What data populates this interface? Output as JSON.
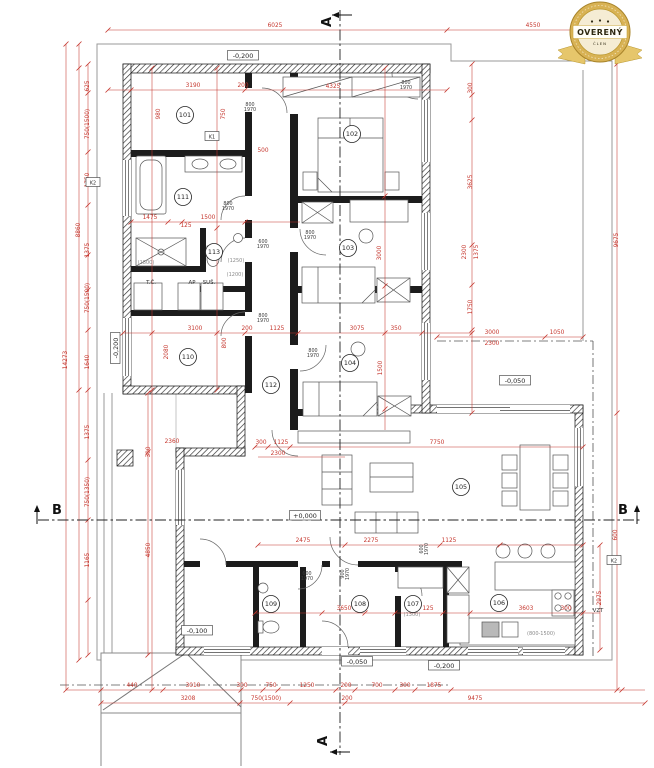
{
  "badge": {
    "title": "OVERENÝ",
    "subtitle": "ČLEN"
  },
  "section": {
    "a": "A",
    "b": "B"
  },
  "colors": {
    "dimension_red": "#c5352c",
    "wall_black": "#1a1a1a",
    "boundary_gray": "#9a9a9a",
    "badge_gold": "#d8b254",
    "badge_cream": "#f5ecd4"
  },
  "levels": [
    {
      "t": "-0,200",
      "x": 243,
      "y": 57,
      "r": 0
    },
    {
      "t": "-0,200",
      "x": 117,
      "y": 348,
      "r": 1
    },
    {
      "t": "+0,000",
      "x": 305,
      "y": 517,
      "r": 0
    },
    {
      "t": "-0,050",
      "x": 515,
      "y": 382,
      "r": 0
    },
    {
      "t": "-0,100",
      "x": 197,
      "y": 632,
      "r": 0
    },
    {
      "t": "-0,050",
      "x": 357,
      "y": 663,
      "r": 0
    },
    {
      "t": "-0,200",
      "x": 444,
      "y": 667,
      "r": 0
    }
  ],
  "rooms": [
    {
      "n": "101",
      "x": 185,
      "y": 115
    },
    {
      "n": "102",
      "x": 352,
      "y": 134
    },
    {
      "n": "103",
      "x": 348,
      "y": 248
    },
    {
      "n": "104",
      "x": 350,
      "y": 363
    },
    {
      "n": "105",
      "x": 461,
      "y": 487
    },
    {
      "n": "106",
      "x": 499,
      "y": 603
    },
    {
      "n": "107",
      "x": 413,
      "y": 604
    },
    {
      "n": "108",
      "x": 360,
      "y": 604
    },
    {
      "n": "109",
      "x": 271,
      "y": 604
    },
    {
      "n": "110",
      "x": 188,
      "y": 357
    },
    {
      "n": "111",
      "x": 183,
      "y": 197
    },
    {
      "n": "112",
      "x": 271,
      "y": 385
    },
    {
      "n": "113",
      "x": 214,
      "y": 252
    }
  ],
  "door_labels": [
    {
      "t": "800/1970",
      "x": 250,
      "y": 106,
      "r": 0
    },
    {
      "t": "800/1970",
      "x": 406,
      "y": 84,
      "r": 0
    },
    {
      "t": "800/1970",
      "x": 228,
      "y": 205,
      "r": 0
    },
    {
      "t": "600/1970",
      "x": 263,
      "y": 243,
      "r": 0
    },
    {
      "t": "800/1970",
      "x": 310,
      "y": 234,
      "r": 0
    },
    {
      "t": "800/1970",
      "x": 313,
      "y": 352,
      "r": 0
    },
    {
      "t": "800/1970",
      "x": 263,
      "y": 317,
      "r": 0
    },
    {
      "t": "600/1970",
      "x": 307,
      "y": 575,
      "r": 0
    },
    {
      "t": "900/1970",
      "x": 344,
      "y": 574,
      "r": 1
    },
    {
      "t": "600/1970",
      "x": 423,
      "y": 549,
      "r": 1
    }
  ],
  "dims": [
    {
      "t": "6025",
      "x": 275,
      "y": 27
    },
    {
      "t": "4550",
      "x": 533,
      "y": 27
    },
    {
      "t": "3190",
      "x": 193,
      "y": 87
    },
    {
      "t": "200",
      "x": 243,
      "y": 87
    },
    {
      "t": "980",
      "x": 160,
      "y": 114,
      "r": 1
    },
    {
      "t": "750",
      "x": 225,
      "y": 114,
      "r": 1
    },
    {
      "t": "500",
      "x": 263,
      "y": 152
    },
    {
      "t": "4325",
      "x": 333,
      "y": 88
    },
    {
      "t": "1475",
      "x": 150,
      "y": 219
    },
    {
      "t": "125",
      "x": 186,
      "y": 227
    },
    {
      "t": "1500",
      "x": 208,
      "y": 219
    },
    {
      "t": "3100",
      "x": 195,
      "y": 330
    },
    {
      "t": "2080",
      "x": 168,
      "y": 352,
      "r": 1
    },
    {
      "t": "800",
      "x": 226,
      "y": 343,
      "r": 1
    },
    {
      "t": "200",
      "x": 247,
      "y": 330
    },
    {
      "t": "1125",
      "x": 277,
      "y": 330
    },
    {
      "t": "3075",
      "x": 357,
      "y": 330
    },
    {
      "t": "350",
      "x": 396,
      "y": 330
    },
    {
      "t": "3000",
      "x": 381,
      "y": 253,
      "r": 1
    },
    {
      "t": "1500",
      "x": 382,
      "y": 368,
      "r": 1
    },
    {
      "t": "2360",
      "x": 172,
      "y": 443
    },
    {
      "t": "300",
      "x": 261,
      "y": 444
    },
    {
      "t": "1125",
      "x": 281,
      "y": 444
    },
    {
      "t": "2300",
      "x": 278,
      "y": 455
    },
    {
      "t": "7750",
      "x": 437,
      "y": 444
    },
    {
      "t": "2475",
      "x": 303,
      "y": 542
    },
    {
      "t": "2275",
      "x": 371,
      "y": 542
    },
    {
      "t": "1125",
      "x": 449,
      "y": 542
    },
    {
      "t": "3650",
      "x": 344,
      "y": 610
    },
    {
      "t": "125",
      "x": 428,
      "y": 610
    },
    {
      "t": "3603",
      "x": 526,
      "y": 610
    },
    {
      "t": "300",
      "x": 566,
      "y": 610
    },
    {
      "t": "440",
      "x": 132,
      "y": 687
    },
    {
      "t": "3010",
      "x": 193,
      "y": 687
    },
    {
      "t": "300",
      "x": 242,
      "y": 687
    },
    {
      "t": "750",
      "x": 271,
      "y": 687
    },
    {
      "t": "1250",
      "x": 307,
      "y": 687
    },
    {
      "t": "200",
      "x": 346,
      "y": 687
    },
    {
      "t": "700",
      "x": 377,
      "y": 687
    },
    {
      "t": "300",
      "x": 405,
      "y": 687
    },
    {
      "t": "1875",
      "x": 434,
      "y": 687
    },
    {
      "t": "3208",
      "x": 188,
      "y": 700
    },
    {
      "t": "750(1500)",
      "x": 266,
      "y": 700
    },
    {
      "t": "200",
      "x": 347,
      "y": 700
    },
    {
      "t": "9475",
      "x": 475,
      "y": 700
    },
    {
      "t": "8860",
      "x": 80,
      "y": 230,
      "r": 1
    },
    {
      "t": "14273",
      "x": 67,
      "y": 360,
      "r": 1
    },
    {
      "t": "625",
      "x": 89,
      "y": 86,
      "r": 1
    },
    {
      "t": "750(1500)",
      "x": 89,
      "y": 124,
      "r": 1
    },
    {
      "t": "1750",
      "x": 89,
      "y": 180,
      "r": 1
    },
    {
      "t": "1375",
      "x": 89,
      "y": 250,
      "r": 1
    },
    {
      "t": "750(1500)",
      "x": 89,
      "y": 298,
      "r": 1
    },
    {
      "t": "1640",
      "x": 89,
      "y": 362,
      "r": 1
    },
    {
      "t": "1375",
      "x": 89,
      "y": 432,
      "r": 1
    },
    {
      "t": "750(1350)",
      "x": 89,
      "y": 492,
      "r": 1
    },
    {
      "t": "1165",
      "x": 89,
      "y": 560,
      "r": 1
    },
    {
      "t": "4850",
      "x": 150,
      "y": 550,
      "r": 1
    },
    {
      "t": "300",
      "x": 150,
      "y": 452,
      "r": 1
    },
    {
      "t": "300",
      "x": 472,
      "y": 88,
      "r": 1
    },
    {
      "t": "3625",
      "x": 472,
      "y": 182,
      "r": 1
    },
    {
      "t": "2300",
      "x": 466,
      "y": 252,
      "r": 1
    },
    {
      "t": "1375",
      "x": 478,
      "y": 252,
      "r": 1
    },
    {
      "t": "1750",
      "x": 472,
      "y": 307,
      "r": 1
    },
    {
      "t": "3000",
      "x": 492,
      "y": 334
    },
    {
      "t": "1050",
      "x": 557,
      "y": 334
    },
    {
      "t": "2300",
      "x": 492,
      "y": 345
    },
    {
      "t": "9675",
      "x": 618,
      "y": 240,
      "r": 1
    },
    {
      "t": "2975",
      "x": 601,
      "y": 598,
      "r": 1
    },
    {
      "t": "600",
      "x": 617,
      "y": 535,
      "r": 1
    }
  ],
  "window_labels": [
    {
      "t": "(1800)",
      "x": 146,
      "y": 264
    },
    {
      "t": "(1250)",
      "x": 236,
      "y": 262
    },
    {
      "t": "(1200)",
      "x": 235,
      "y": 276
    },
    {
      "t": "(1300)",
      "x": 412,
      "y": 616
    },
    {
      "t": "(800-1500)",
      "x": 541,
      "y": 635
    }
  ],
  "tech_labels": [
    {
      "t": "T.Č.",
      "x": 151,
      "y": 284
    },
    {
      "t": "AP",
      "x": 192,
      "y": 284
    },
    {
      "t": "SUŠ.",
      "x": 209,
      "y": 284
    },
    {
      "t": "VZT",
      "x": 598,
      "y": 612
    }
  ],
  "k_labels": [
    {
      "t": "K1",
      "x": 212,
      "y": 137
    },
    {
      "t": "K2",
      "x": 93,
      "y": 183
    },
    {
      "t": "K2",
      "x": 614,
      "y": 561
    }
  ]
}
